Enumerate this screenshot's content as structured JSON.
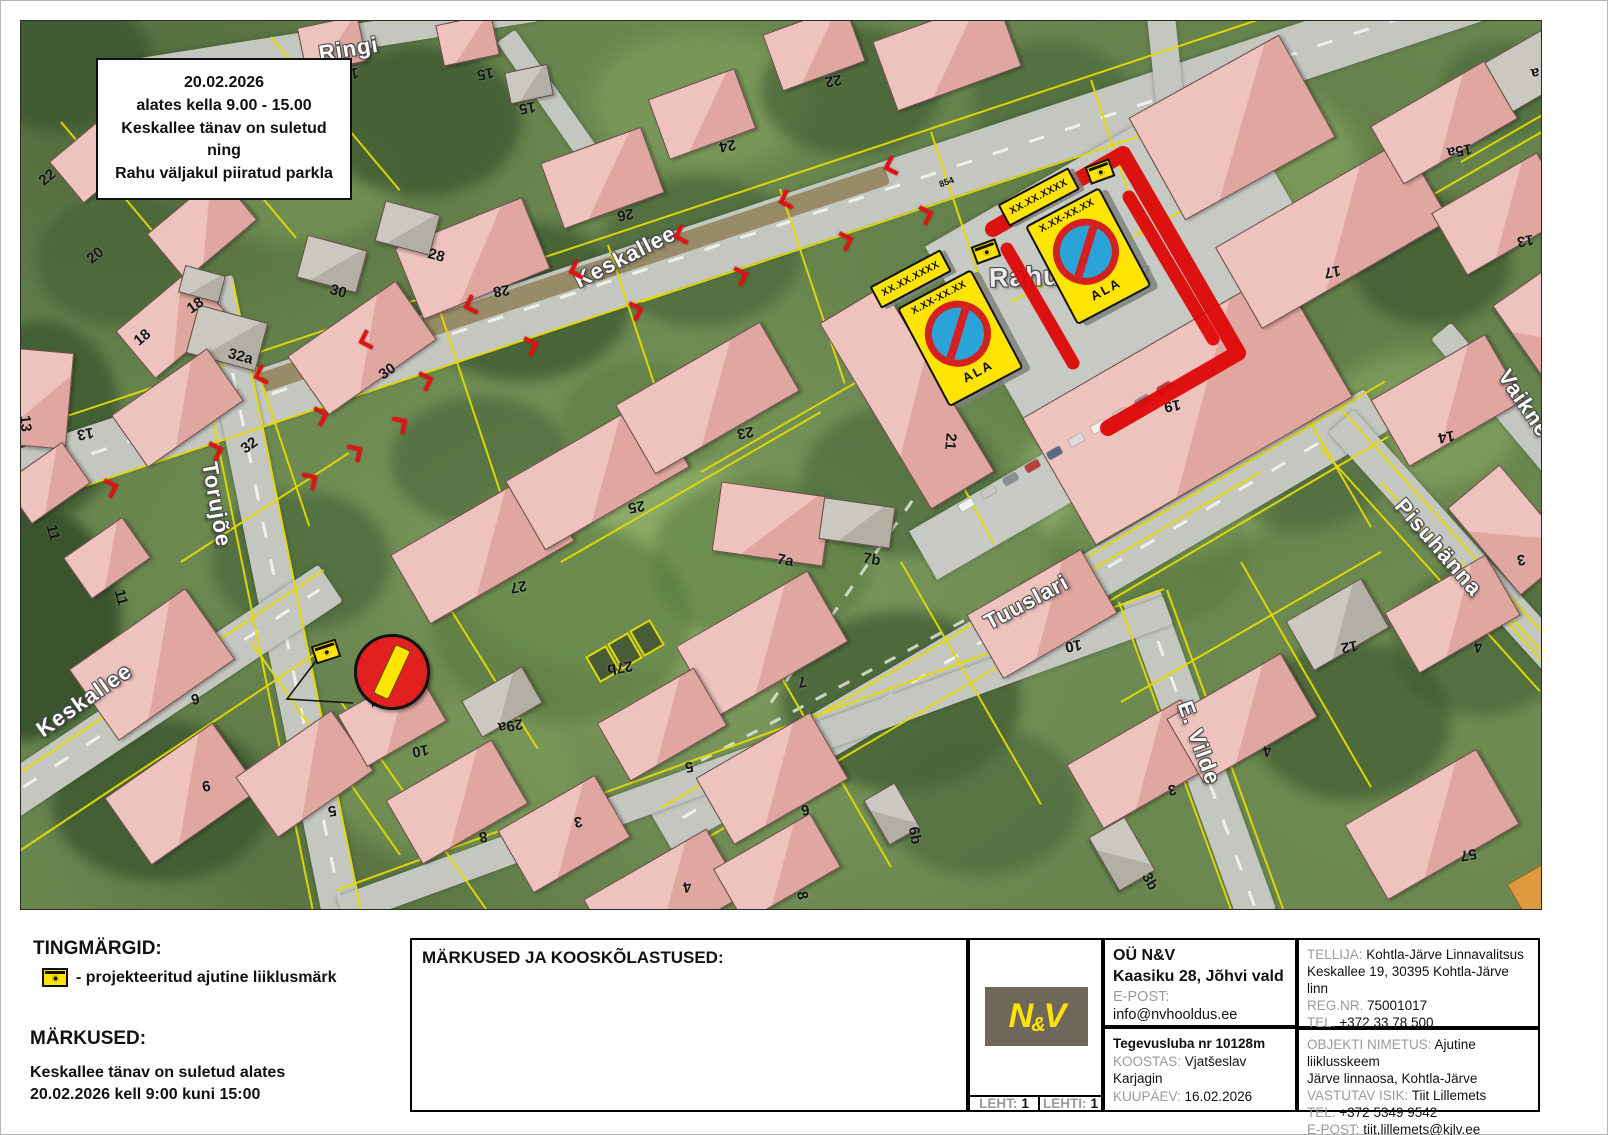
{
  "map": {
    "info_box": {
      "lines": [
        "20.02.2026",
        "alates kella 9.00 - 15.00",
        "Keskallee tänav on suletud",
        "ning",
        "Rahu väljakul piiratud parkla"
      ]
    },
    "street_labels": [
      {
        "text": "Ringi",
        "x": 318,
        "y": 40,
        "r": -9
      },
      {
        "text": "Keskallee",
        "x": 575,
        "y": 268,
        "r": -27
      },
      {
        "text": "Torujõe",
        "x": 208,
        "y": 448,
        "r": 80
      },
      {
        "text": "Keskallee",
        "x": 38,
        "y": 718,
        "r": -35
      },
      {
        "text": "Tuuslari",
        "x": 985,
        "y": 610,
        "r": -28
      },
      {
        "text": "E. Vilde",
        "x": 1183,
        "y": 688,
        "r": 70
      },
      {
        "text": "Pisuhänna",
        "x": 1398,
        "y": 488,
        "r": 49
      },
      {
        "text": "Vaikne",
        "x": 1502,
        "y": 358,
        "r": 56
      },
      {
        "text": "Rahu väljak",
        "x": 988,
        "y": 262,
        "r": -2,
        "fs": 27
      }
    ],
    "parcel_labels": [
      {
        "t": "22",
        "x": 38,
        "y": 168,
        "r": -40
      },
      {
        "t": "20",
        "x": 86,
        "y": 246,
        "r": -40
      },
      {
        "t": "18",
        "x": 133,
        "y": 328,
        "r": -40
      },
      {
        "t": "18",
        "x": 186,
        "y": 296,
        "r": -35
      },
      {
        "t": "16",
        "x": 341,
        "y": 64,
        "r": 170
      },
      {
        "t": "15",
        "x": 476,
        "y": 64,
        "r": 170
      },
      {
        "t": "15",
        "x": 518,
        "y": 98,
        "r": 170
      },
      {
        "t": "24",
        "x": 718,
        "y": 136,
        "r": 170
      },
      {
        "t": "22",
        "x": 824,
        "y": 71,
        "r": 170
      },
      {
        "t": "26",
        "x": 616,
        "y": 205,
        "r": 170
      },
      {
        "t": "28",
        "x": 492,
        "y": 281,
        "r": 170
      },
      {
        "t": "28",
        "x": 427,
        "y": 246,
        "r": 15
      },
      {
        "t": "30",
        "x": 329,
        "y": 282,
        "r": 15
      },
      {
        "t": "30",
        "x": 378,
        "y": 362,
        "r": -35
      },
      {
        "t": "32a",
        "x": 227,
        "y": 347,
        "r": 15
      },
      {
        "t": "13",
        "x": 76,
        "y": 424,
        "r": 170
      },
      {
        "t": "32",
        "x": 240,
        "y": 436,
        "r": -35
      },
      {
        "t": "13",
        "x": 16,
        "y": 414,
        "r": 85
      },
      {
        "t": "11",
        "x": 44,
        "y": 523,
        "r": 75
      },
      {
        "t": "11",
        "x": 112,
        "y": 588,
        "r": 75
      },
      {
        "t": "25",
        "x": 627,
        "y": 497,
        "r": 170
      },
      {
        "t": "23",
        "x": 736,
        "y": 423,
        "r": 170
      },
      {
        "t": "27",
        "x": 509,
        "y": 577,
        "r": 170
      },
      {
        "t": "21",
        "x": 941,
        "y": 432,
        "r": 95
      },
      {
        "t": "19",
        "x": 1163,
        "y": 396,
        "r": 170
      },
      {
        "t": "7a",
        "x": 776,
        "y": 551,
        "r": 10
      },
      {
        "t": "7b",
        "x": 862,
        "y": 550,
        "r": 10
      },
      {
        "t": "27b",
        "x": 606,
        "y": 658,
        "r": 170
      },
      {
        "t": "29a",
        "x": 497,
        "y": 716,
        "r": 170
      },
      {
        "t": "10",
        "x": 411,
        "y": 741,
        "r": 170
      },
      {
        "t": "6",
        "x": 190,
        "y": 689,
        "r": 170
      },
      {
        "t": "9",
        "x": 201,
        "y": 776,
        "r": 170
      },
      {
        "t": "5",
        "x": 327,
        "y": 801,
        "r": 170
      },
      {
        "t": "8",
        "x": 478,
        "y": 827,
        "r": 170
      },
      {
        "t": "3",
        "x": 573,
        "y": 812,
        "r": 170
      },
      {
        "t": "4",
        "x": 682,
        "y": 877,
        "r": 170
      },
      {
        "t": "5",
        "x": 684,
        "y": 757,
        "r": 170
      },
      {
        "t": "7",
        "x": 797,
        "y": 672,
        "r": 170
      },
      {
        "t": "6",
        "x": 800,
        "y": 800,
        "r": 170
      },
      {
        "t": "6b",
        "x": 905,
        "y": 826,
        "r": 80
      },
      {
        "t": "8",
        "x": 797,
        "y": 886,
        "r": 80
      },
      {
        "t": "10",
        "x": 1064,
        "y": 636,
        "r": 170
      },
      {
        "t": "3b",
        "x": 1140,
        "y": 872,
        "r": 60
      },
      {
        "t": "3",
        "x": 1167,
        "y": 780,
        "r": 170
      },
      {
        "t": "4",
        "x": 1262,
        "y": 741,
        "r": 170
      },
      {
        "t": "12",
        "x": 1340,
        "y": 637,
        "r": 170
      },
      {
        "t": "4",
        "x": 1473,
        "y": 637,
        "r": 170
      },
      {
        "t": "14",
        "x": 1437,
        "y": 427,
        "r": 170
      },
      {
        "t": "57",
        "x": 1459,
        "y": 845,
        "r": 170
      },
      {
        "t": "17",
        "x": 1323,
        "y": 262,
        "r": 170
      },
      {
        "t": "13",
        "x": 1516,
        "y": 231,
        "r": 170
      },
      {
        "t": "15a",
        "x": 1446,
        "y": 141,
        "r": 170
      },
      {
        "t": "17a",
        "x": 1530,
        "y": 62,
        "r": 170
      },
      {
        "t": "13a",
        "x": 1556,
        "y": 107,
        "r": 170
      },
      {
        "t": "9",
        "x": 1556,
        "y": 343,
        "r": 20
      },
      {
        "t": "3",
        "x": 1516,
        "y": 550,
        "r": 170
      }
    ],
    "code_labels": [
      {
        "t": "854",
        "x": 938,
        "y": 176,
        "r": -20
      },
      {
        "t": "854",
        "x": 1048,
        "y": 176,
        "r": -20
      },
      {
        "t": "362/364",
        "x": 948,
        "y": 292,
        "r": -28
      },
      {
        "t": "362/364",
        "x": 1062,
        "y": 202,
        "r": -28
      },
      {
        "t": "331",
        "x": 366,
        "y": 694,
        "r": 85
      }
    ],
    "signs": {
      "plate_date": "XX.XX.XXXX",
      "plate_time": "X.XX-XX.XX",
      "plate_zone": "ALA"
    }
  },
  "legend": {
    "title": "TINGMÄRGID:",
    "item": "- projekteeritud ajutine liiklusmärk"
  },
  "notes": {
    "title": "MÄRKUSED:",
    "lines": [
      "Keskallee tänav on suletud alates",
      "20.02.2026 kell 9:00 kuni 15:00"
    ]
  },
  "titleblock": {
    "remarks_title": "MÄRKUSED JA KOOSKÕLASTUSED:",
    "logo_text_left": "N",
    "logo_text_amp": "&",
    "logo_text_right": "V",
    "company": {
      "name": "OÜ N&V",
      "address": "Kaasiku 28, Jõhvi vald",
      "email_label": "E-POST:",
      "email": "info@nvhooldus.ee"
    },
    "license": {
      "line1": "Tegevusluba nr 10128m",
      "koostas_label": "KOOSTAS:",
      "koostas": "Vjatšeslav Karjagin",
      "kuupaev_label": "KUUPÄEV:",
      "kuupaev": "16.02.2026"
    },
    "client": {
      "label": "TELLIJA:",
      "name": "Kohtla-Järve Linnavalitsus",
      "address": "Keskallee 19, 30395 Kohtla-Järve linn",
      "reg_label": "REG.NR.",
      "reg": "75001017",
      "tel_label": "TEL.",
      "tel": "+372 33 78 500",
      "email_label": "E-POST:",
      "email": "linnavalitsus@kjlv.ee"
    },
    "object": {
      "label": "OBJEKTI NIMETUS:",
      "name": "Ajutine liiklusskeem",
      "line2": "Järve linnaosa, Kohtla-Järve",
      "resp_label": "VASTUTAV ISIK:",
      "resp": "Tiit Lillemets",
      "tel_label": "TEL.",
      "tel": "+372 5349 9542",
      "email_label": "E-POST:",
      "email": "tiit.lillemets@kjlv.ee"
    },
    "sheet": {
      "leht_label": "LEHT:",
      "leht": "1",
      "lehti_label": "LEHTI:",
      "lehti": "1"
    }
  },
  "colors": {
    "closure_red": "#dd0707",
    "sign_yellow": "#ffe400",
    "no_parking_blue": "#2aa3d8",
    "no_parking_ring": "#d42020",
    "parcel_yellow": "#e4d900"
  }
}
